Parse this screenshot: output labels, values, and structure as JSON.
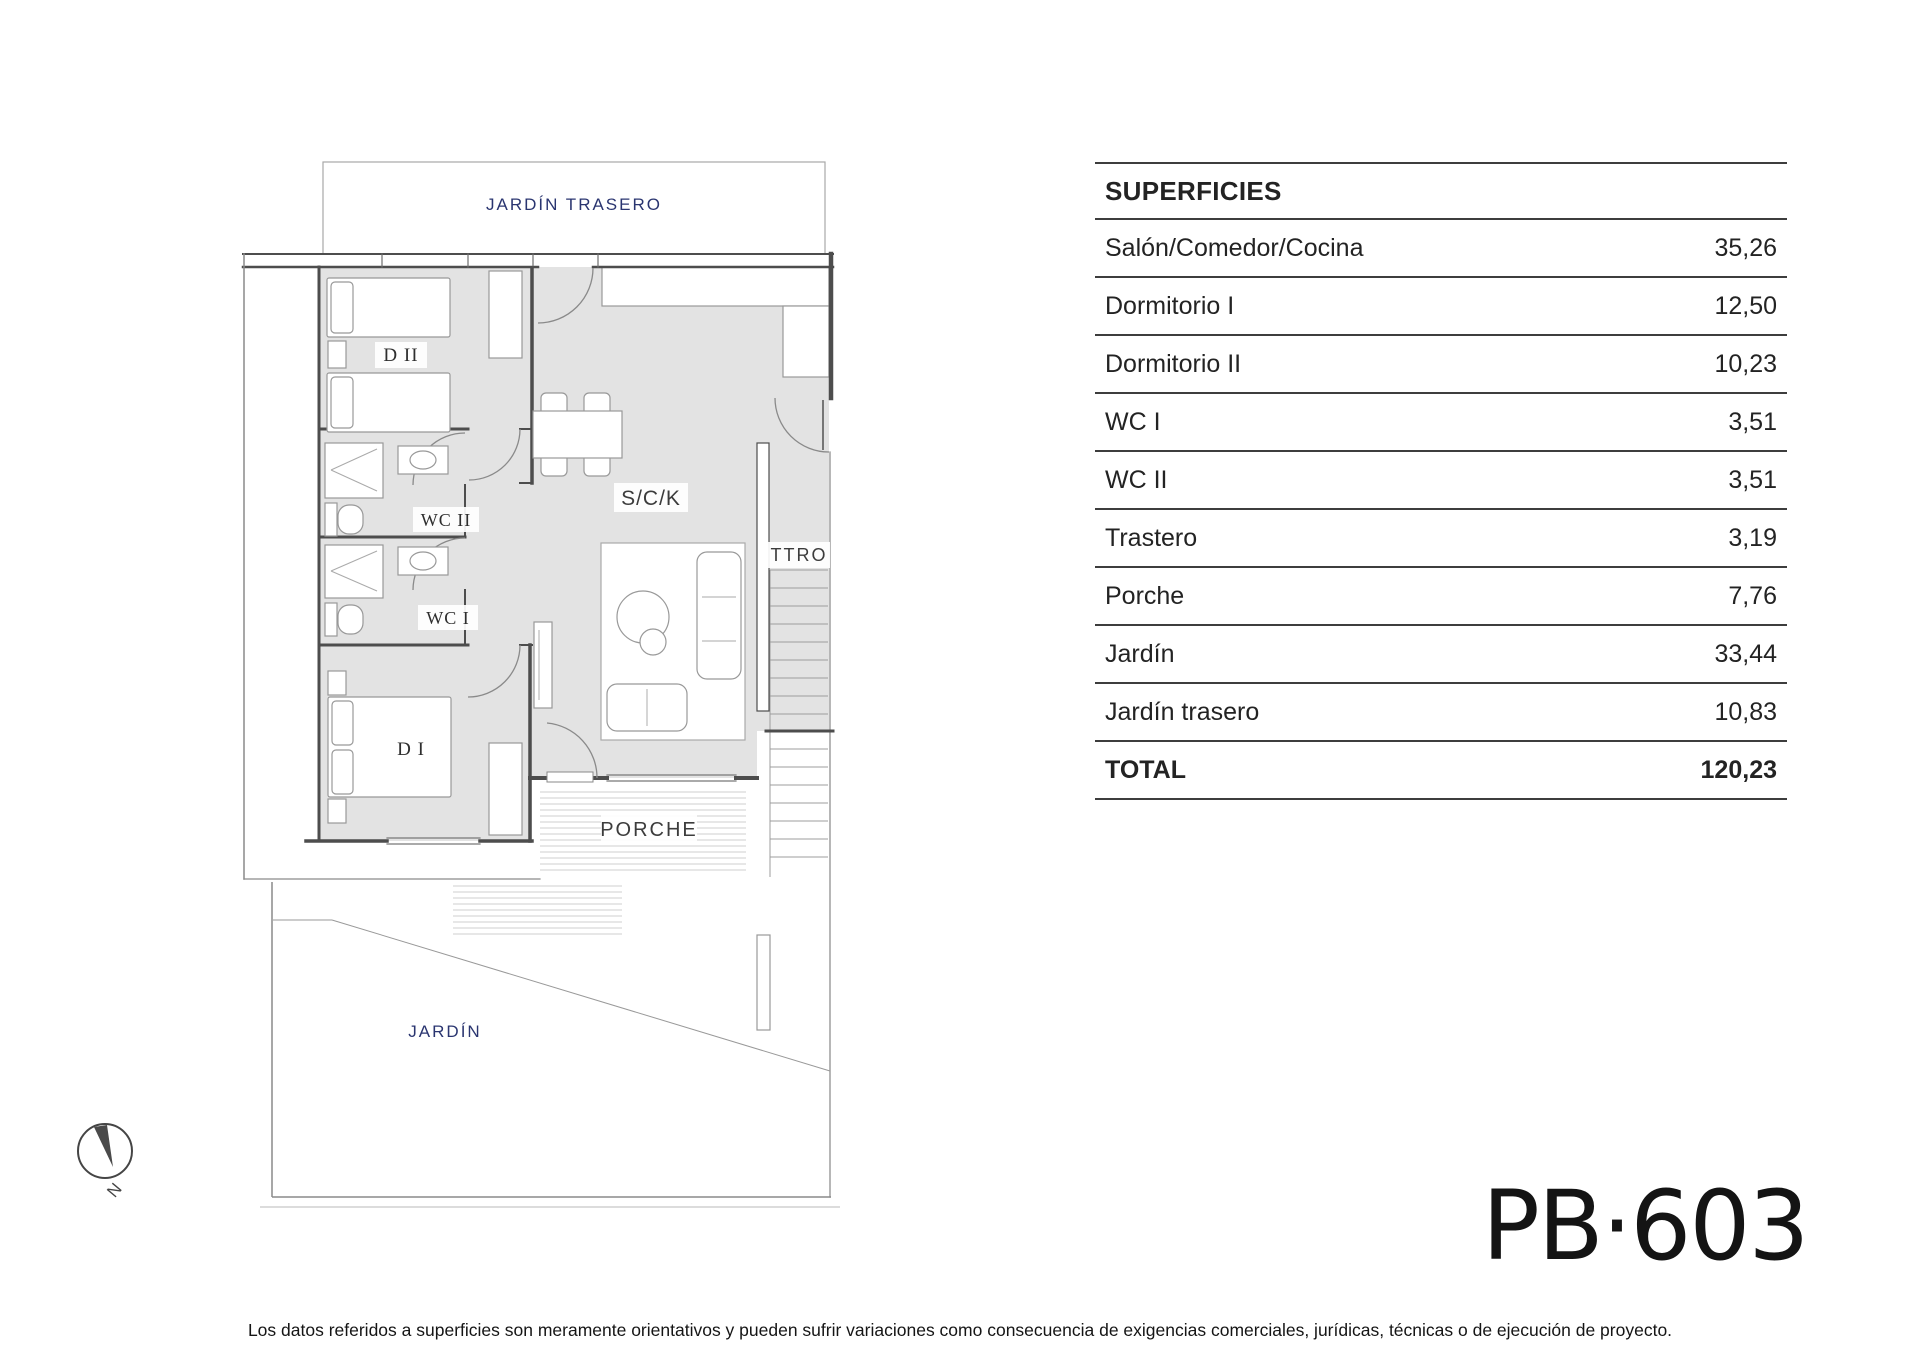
{
  "document": {
    "plan_code": "PB·603",
    "disclaimer": "Los datos referidos a superficies son meramente orientativos y pueden sufrir variaciones como consecuencia de exigencias comerciales, jurídicas, técnicas o de ejecución de proyecto."
  },
  "surfaces_table": {
    "title": "SUPERFICIES",
    "rows": [
      {
        "label": "Salón/Comedor/Cocina",
        "value": "35,26"
      },
      {
        "label": "Dormitorio I",
        "value": "12,50"
      },
      {
        "label": "Dormitorio II",
        "value": "10,23"
      },
      {
        "label": "WC I",
        "value": "3,51"
      },
      {
        "label": "WC II",
        "value": "3,51"
      },
      {
        "label": "Trastero",
        "value": "3,19"
      },
      {
        "label": "Porche",
        "value": "7,76"
      },
      {
        "label": "Jardín",
        "value": "33,44"
      },
      {
        "label": "Jardín trasero",
        "value": "10,83"
      }
    ],
    "total": {
      "label": "TOTAL",
      "value": "120,23"
    }
  },
  "floor_plan": {
    "labels": {
      "jardin_trasero": "JARDÍN TRASERO",
      "dormitorio_2": "D II",
      "wc_2": "WC II",
      "wc_1": "WC I",
      "dormitorio_1": "D I",
      "salon_comedor_cocina": "S/C/K",
      "trastero": "TTRO",
      "porche": "PORCHE",
      "jardin": "JARDÍN",
      "north": "N"
    },
    "colors": {
      "floor_fill": "#e3e3e3",
      "wall": "#4d4d4d",
      "furniture_stroke": "#999999",
      "garden_label_navy": "#2a3570",
      "table_line": "#3d3d3d"
    }
  }
}
